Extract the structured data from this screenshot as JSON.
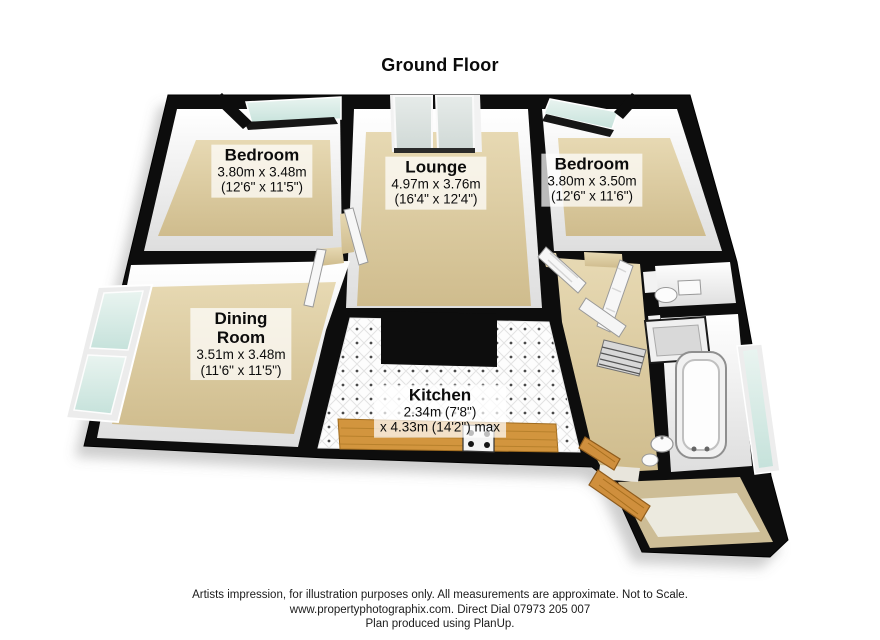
{
  "title": "Ground Floor",
  "rooms": {
    "bedroom1": {
      "name": "Bedroom",
      "metric": "3.80m x 3.48m",
      "imperial": "(12'6\" x 11'5\")"
    },
    "lounge": {
      "name": "Lounge",
      "metric": "4.97m x 3.76m",
      "imperial": "(16'4\" x 12'4\")"
    },
    "bedroom2": {
      "name": "Bedroom",
      "metric": "3.80m x 3.50m",
      "imperial": "(12'6\" x 11'6\")"
    },
    "dining_room": {
      "name_line1": "Dining",
      "name_line2": "Room",
      "metric": "3.51m x 3.48m",
      "imperial": "(11'6\" x 11'5\")"
    },
    "kitchen": {
      "name": "Kitchen",
      "metric": "2.34m (7'8\")",
      "imperial": "x 4.33m (14'2\") max"
    }
  },
  "footer": {
    "line1": "Artists impression, for illustration purposes only. All measurements are approximate. Not to Scale.",
    "line2": "www.propertyphotographix.com. Direct Dial 07973 205 007",
    "line3": "Plan produced using PlanUp."
  },
  "colors": {
    "wall": "#0d0d0d",
    "floor_beige": "#d5c498",
    "kitchen_counter": "#d2953e",
    "glass": "#d9ece8",
    "label_background": "rgba(255,255,255,0.72)"
  }
}
